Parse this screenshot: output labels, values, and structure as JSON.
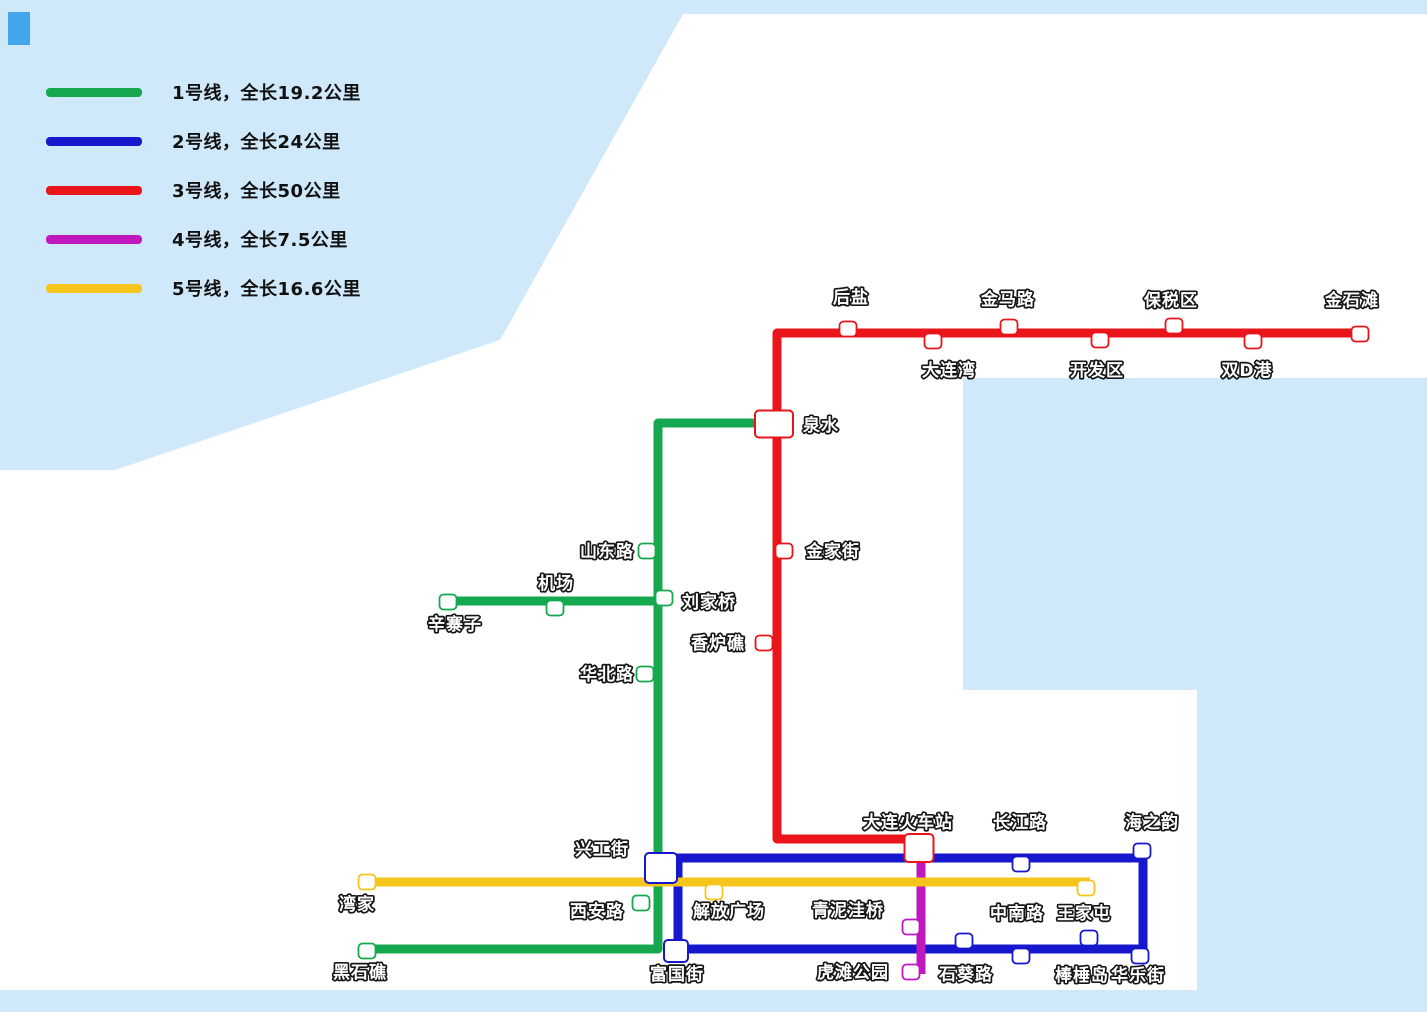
{
  "colors": {
    "sea": "#CFE9FA",
    "land": "#FFFFFF",
    "corner_patch": "#41A7EA",
    "line1_green": "#15A84F",
    "line2_blue": "#1717CE",
    "line3_red": "#E9151B",
    "line4_magenta": "#BE18BE",
    "line5_yellow": "#F6C51B",
    "label_fill": "#FFFFFF",
    "label_outline": "#161616",
    "legend_text": "#111111"
  },
  "legend": {
    "items": [
      {
        "id": "line-1",
        "color": "#15A84F",
        "label": "1号线，全长19.2公里"
      },
      {
        "id": "line-2",
        "color": "#1717CE",
        "label": "2号线，全长24公里"
      },
      {
        "id": "line-3",
        "color": "#E9151B",
        "label": "3号线，全长50公里"
      },
      {
        "id": "line-4",
        "color": "#BE18BE",
        "label": "4号线，全长7.5公里"
      },
      {
        "id": "line-5",
        "color": "#F6C51B",
        "label": "5号线，全长16.6公里"
      }
    ]
  },
  "map": {
    "width": 1427,
    "height": 1012,
    "land": {
      "points": [
        [
          683,
          14
        ],
        [
          1427,
          14
        ],
        [
          1427,
          378
        ],
        [
          963,
          378
        ],
        [
          963,
          690
        ],
        [
          1197,
          690
        ],
        [
          1197,
          990
        ],
        [
          0,
          990
        ],
        [
          0,
          470
        ],
        [
          115,
          470
        ],
        [
          500,
          340
        ]
      ]
    },
    "corner_patch": {
      "x": 8,
      "y": 12,
      "w": 22,
      "h": 33
    },
    "lines": [
      {
        "id": "line-1-main",
        "name": "1号线",
        "length": "19.2公里",
        "color": "#15A84F",
        "width": 9,
        "points": [
          [
            756,
            423
          ],
          [
            658,
            423
          ],
          [
            658,
            949
          ],
          [
            367,
            949
          ]
        ]
      },
      {
        "id": "line-1-branch",
        "name": "1号线",
        "length": "19.2公里",
        "color": "#15A84F",
        "width": 9,
        "points": [
          [
            448,
            601
          ],
          [
            658,
            601
          ]
        ]
      },
      {
        "id": "line-2-loop",
        "name": "2号线",
        "length": "24公里",
        "color": "#1717CE",
        "width": 9,
        "points": [
          [
            664,
            858
          ],
          [
            1143,
            858
          ],
          [
            1143,
            949
          ],
          [
            678,
            949
          ],
          [
            678,
            858
          ]
        ]
      },
      {
        "id": "line-3",
        "name": "3号线",
        "length": "50公里",
        "color": "#E9151B",
        "width": 9,
        "points": [
          [
            1362,
            333
          ],
          [
            777,
            333
          ],
          [
            777,
            839
          ],
          [
            919,
            839
          ]
        ]
      },
      {
        "id": "line-4",
        "name": "4号线",
        "length": "7.5公里",
        "color": "#BE18BE",
        "width": 9,
        "points": [
          [
            921,
            850
          ],
          [
            921,
            974
          ]
        ]
      },
      {
        "id": "line-5",
        "name": "5号线",
        "length": "16.6公里",
        "color": "#F6C51B",
        "width": 9,
        "points": [
          [
            367,
            882
          ],
          [
            1090,
            882
          ]
        ]
      }
    ],
    "stations": [
      {
        "id": "houyan",
        "name": "后盐",
        "x": 848,
        "y": 329,
        "line": "3",
        "label": {
          "x": 851,
          "y": 303,
          "anchor": "middle"
        }
      },
      {
        "id": "dalianwan",
        "name": "大连湾",
        "x": 933,
        "y": 341,
        "line": "3",
        "label": {
          "x": 949,
          "y": 376,
          "anchor": "middle"
        }
      },
      {
        "id": "jinmalu",
        "name": "金马路",
        "x": 1009,
        "y": 327,
        "line": "3",
        "label": {
          "x": 1008,
          "y": 305,
          "anchor": "middle"
        }
      },
      {
        "id": "kaifaqu",
        "name": "开发区",
        "x": 1100,
        "y": 340,
        "line": "3",
        "label": {
          "x": 1097,
          "y": 376,
          "anchor": "middle"
        }
      },
      {
        "id": "baoshuiqu",
        "name": "保税区",
        "x": 1174,
        "y": 326,
        "line": "3",
        "label": {
          "x": 1171,
          "y": 306,
          "anchor": "middle"
        }
      },
      {
        "id": "shuang-d-gang",
        "name": "双D港",
        "x": 1253,
        "y": 341,
        "line": "3",
        "label": {
          "x": 1247,
          "y": 376,
          "anchor": "middle"
        }
      },
      {
        "id": "jinshitan",
        "name": "金石滩",
        "x": 1360,
        "y": 334,
        "line": "3",
        "label": {
          "x": 1352,
          "y": 306,
          "anchor": "middle"
        }
      },
      {
        "id": "jinjiajie",
        "name": "金家街",
        "x": 784,
        "y": 551,
        "line": "3",
        "label": {
          "x": 806,
          "y": 557,
          "anchor": "start"
        }
      },
      {
        "id": "xianglujiao",
        "name": "香炉礁",
        "x": 764,
        "y": 643,
        "line": "3",
        "label": {
          "x": 745,
          "y": 649,
          "anchor": "end"
        }
      },
      {
        "id": "quanshui",
        "name": "泉水",
        "x": 774,
        "y": 424,
        "w": 38,
        "h": 27,
        "outline": "#E9151B",
        "label": {
          "x": 803,
          "y": 431,
          "anchor": "start"
        }
      },
      {
        "id": "shandonglu",
        "name": "山东路",
        "x": 647,
        "y": 551,
        "line": "1",
        "label": {
          "x": 634,
          "y": 557,
          "anchor": "end"
        }
      },
      {
        "id": "liujiaqiao",
        "name": "刘家桥",
        "x": 664,
        "y": 598,
        "line": "1",
        "label": {
          "x": 682,
          "y": 608,
          "anchor": "start"
        }
      },
      {
        "id": "jichang",
        "name": "机场",
        "x": 555,
        "y": 608,
        "line": "1",
        "label": {
          "x": 556,
          "y": 589,
          "anchor": "middle"
        }
      },
      {
        "id": "xinzhaizi",
        "name": "辛寨子",
        "x": 448,
        "y": 602,
        "line": "1",
        "label": {
          "x": 455,
          "y": 630,
          "anchor": "middle"
        }
      },
      {
        "id": "huabeilu",
        "name": "华北路",
        "x": 645,
        "y": 674,
        "line": "1",
        "label": {
          "x": 634,
          "y": 680,
          "anchor": "end"
        }
      },
      {
        "id": "xinggongjie",
        "name": "兴工街",
        "x": 661,
        "y": 868,
        "w": 32,
        "h": 30,
        "outline": "#1717CE",
        "label": {
          "x": 602,
          "y": 855,
          "anchor": "middle"
        }
      },
      {
        "id": "xianlu",
        "name": "西安路",
        "x": 641,
        "y": 903,
        "line": "1",
        "label": {
          "x": 597,
          "y": 917,
          "anchor": "middle"
        }
      },
      {
        "id": "heishijiao",
        "name": "黑石礁",
        "x": 367,
        "y": 951,
        "line": "1",
        "label": {
          "x": 360,
          "y": 978,
          "anchor": "middle"
        }
      },
      {
        "id": "dalian-railway",
        "name": "大连火车站",
        "x": 919,
        "y": 848,
        "w": 29,
        "h": 28,
        "outline": "#E9151B",
        "label": {
          "x": 908,
          "y": 828,
          "anchor": "middle"
        }
      },
      {
        "id": "changjianglu",
        "name": "长江路",
        "x": 1021,
        "y": 864,
        "line": "2",
        "label": {
          "x": 1020,
          "y": 828,
          "anchor": "middle"
        }
      },
      {
        "id": "haizhiyun",
        "name": "海之韵",
        "x": 1142,
        "y": 851,
        "line": "2",
        "label": {
          "x": 1152,
          "y": 828,
          "anchor": "middle"
        }
      },
      {
        "id": "hualejie",
        "name": "华乐街",
        "x": 1140,
        "y": 956,
        "line": "2",
        "label": {
          "x": 1138,
          "y": 981,
          "anchor": "middle"
        }
      },
      {
        "id": "bangchuidao",
        "name": "棒棰岛",
        "x": 1089,
        "y": 938,
        "line": "2",
        "label": {
          "x": 1082,
          "y": 981,
          "anchor": "middle"
        }
      },
      {
        "id": "zhongnanlu",
        "name": "中南路",
        "x": 1021,
        "y": 956,
        "line": "2",
        "label": {
          "x": 1017,
          "y": 919,
          "anchor": "middle"
        }
      },
      {
        "id": "shikuilu",
        "name": "石葵路",
        "x": 964,
        "y": 941,
        "line": "2",
        "label": {
          "x": 966,
          "y": 980,
          "anchor": "middle"
        }
      },
      {
        "id": "fuguojie",
        "name": "富国街",
        "x": 676,
        "y": 951,
        "w": 24,
        "h": 22,
        "outline": "#1717CE",
        "label": {
          "x": 677,
          "y": 980,
          "anchor": "middle"
        }
      },
      {
        "id": "wanjia",
        "name": "湾家",
        "x": 367,
        "y": 882,
        "line": "5",
        "label": {
          "x": 357,
          "y": 910,
          "anchor": "middle"
        }
      },
      {
        "id": "jiefangguangchang",
        "name": "解放广场",
        "x": 714,
        "y": 892,
        "line": "5",
        "label": {
          "x": 729,
          "y": 917,
          "anchor": "middle"
        }
      },
      {
        "id": "wangjiatun",
        "name": "王家屯",
        "x": 1086,
        "y": 888,
        "line": "5",
        "label": {
          "x": 1084,
          "y": 919,
          "anchor": "middle"
        }
      },
      {
        "id": "qingniwaqiao",
        "name": "青泥洼桥",
        "x": 911,
        "y": 927,
        "line": "4",
        "label": {
          "x": 884,
          "y": 916,
          "anchor": "end"
        }
      },
      {
        "id": "hutangongyuan",
        "name": "虎滩公园",
        "x": 911,
        "y": 972,
        "line": "4",
        "label": {
          "x": 889,
          "y": 978,
          "anchor": "end"
        }
      }
    ]
  }
}
